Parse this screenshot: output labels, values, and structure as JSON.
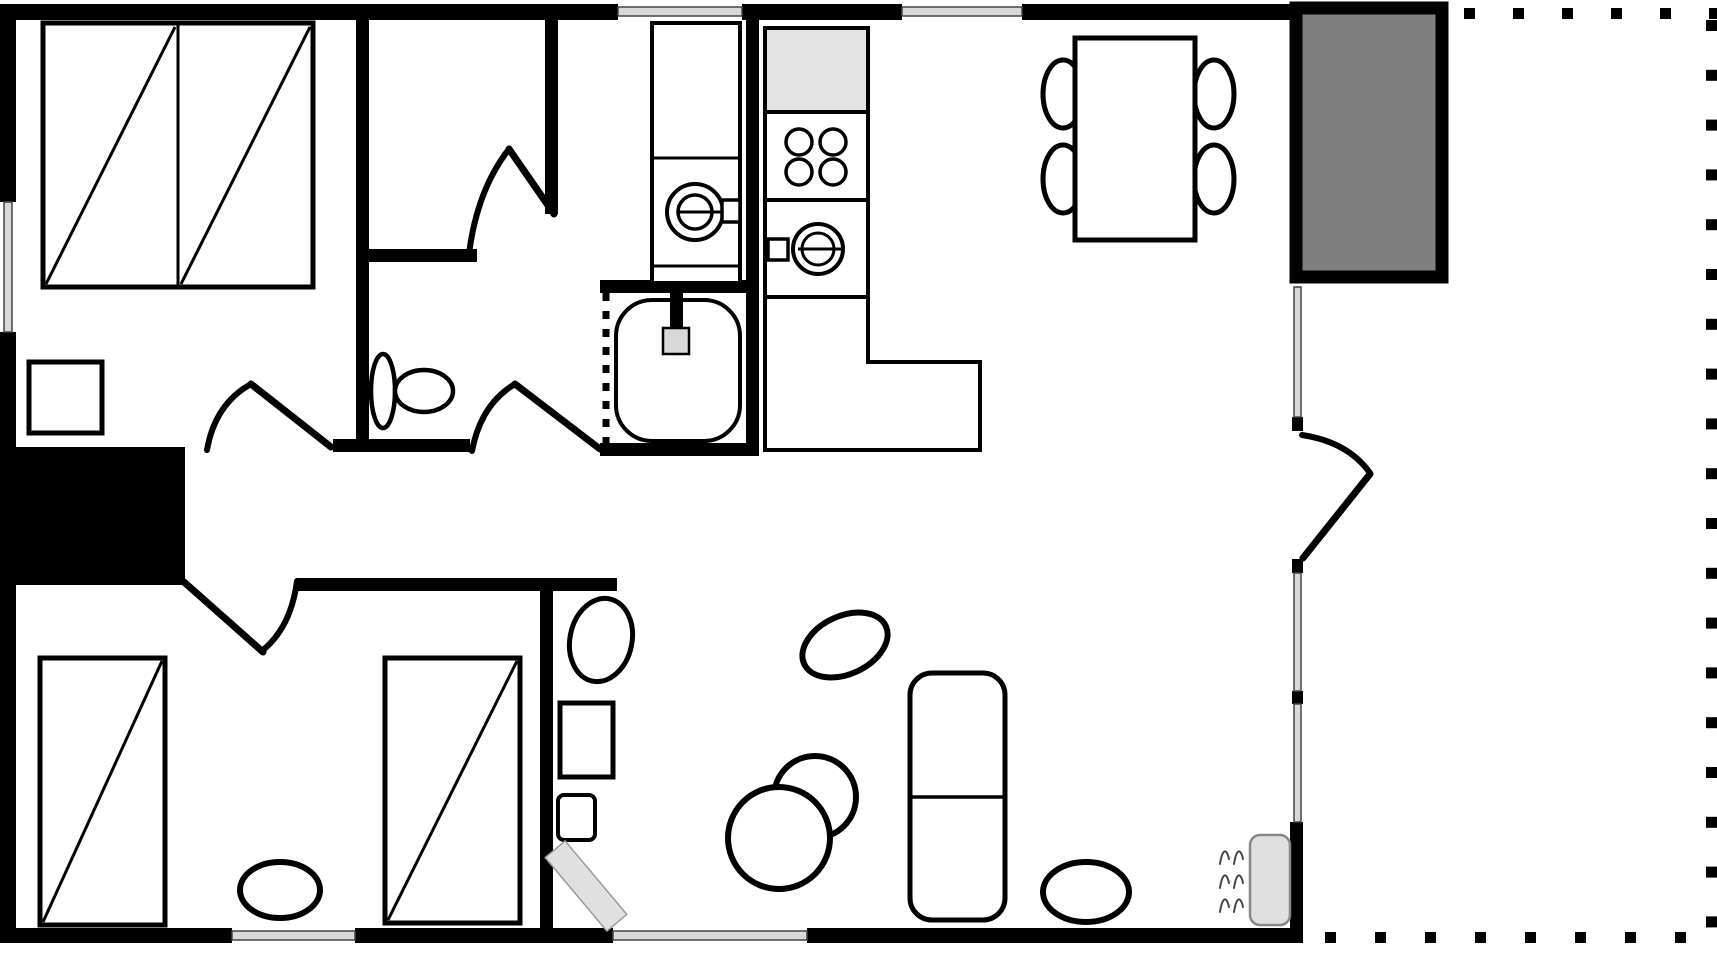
{
  "diagram": {
    "type": "floor-plan",
    "canvas": {
      "width": 1717,
      "height": 955,
      "background": "#ffffff"
    },
    "colors": {
      "wall": "#000000",
      "window_glass": "#d9d9d9",
      "porch_fill": "#7f7f7f",
      "appliance_fill": "#e3e3e3",
      "slab_fill": "#e0e0e0",
      "line": "#000000"
    },
    "elements": [
      {
        "name": "wall-top-left",
        "type": "rect",
        "x": 0,
        "y": 4,
        "w": 618,
        "h": 16,
        "fill": "#000000"
      },
      {
        "name": "wall-top-mid",
        "type": "rect",
        "x": 742,
        "y": 4,
        "w": 160,
        "h": 16,
        "fill": "#000000"
      },
      {
        "name": "wall-top-right",
        "type": "rect",
        "x": 1022,
        "y": 4,
        "w": 272,
        "h": 16,
        "fill": "#000000"
      },
      {
        "name": "wall-left-upper",
        "type": "rect",
        "x": 0,
        "y": 4,
        "w": 16,
        "h": 198,
        "fill": "#000000"
      },
      {
        "name": "wall-left-lower",
        "type": "rect",
        "x": 0,
        "y": 332,
        "w": 16,
        "h": 611,
        "fill": "#000000"
      },
      {
        "name": "wall-bottom-1",
        "type": "rect",
        "x": 0,
        "y": 928,
        "w": 232,
        "h": 15,
        "fill": "#000000"
      },
      {
        "name": "wall-bottom-2",
        "type": "rect",
        "x": 355,
        "y": 928,
        "w": 258,
        "h": 15,
        "fill": "#000000"
      },
      {
        "name": "wall-bottom-3",
        "type": "rect",
        "x": 807,
        "y": 928,
        "w": 496,
        "h": 15,
        "fill": "#000000"
      },
      {
        "name": "wall-right-lower",
        "type": "rect",
        "x": 1290,
        "y": 822,
        "w": 13,
        "h": 121,
        "fill": "#000000"
      },
      {
        "name": "entry-door-post-top",
        "type": "rect",
        "x": 1292,
        "y": 417,
        "w": 11,
        "h": 14,
        "fill": "#000000"
      },
      {
        "name": "entry-door-post-bottom",
        "type": "rect",
        "x": 1292,
        "y": 559,
        "w": 11,
        "h": 14,
        "fill": "#000000"
      },
      {
        "name": "right-window-post",
        "type": "rect",
        "x": 1292,
        "y": 691,
        "w": 11,
        "h": 13,
        "fill": "#000000"
      },
      {
        "name": "wall-bedroom1-right",
        "type": "rect",
        "x": 356,
        "y": 16,
        "w": 13,
        "h": 426,
        "fill": "#000000"
      },
      {
        "name": "wall-closet-right",
        "type": "rect",
        "x": 545,
        "y": 16,
        "w": 13,
        "h": 198,
        "fill": "#000000"
      },
      {
        "name": "wall-kitchen",
        "type": "rect",
        "x": 746,
        "y": 16,
        "w": 13,
        "h": 440,
        "fill": "#000000"
      },
      {
        "name": "wall-closet-bottom",
        "type": "rect",
        "x": 356,
        "y": 249,
        "w": 121,
        "h": 13,
        "fill": "#000000"
      },
      {
        "name": "wall-laundry-divider",
        "type": "rect",
        "x": 600,
        "y": 280,
        "w": 159,
        "h": 13,
        "fill": "#000000"
      },
      {
        "name": "wall-toilet-bottom",
        "type": "rect",
        "x": 333,
        "y": 439,
        "w": 137,
        "h": 13,
        "fill": "#000000"
      },
      {
        "name": "wall-bathroom-bottom",
        "type": "rect",
        "x": 600,
        "y": 443,
        "w": 159,
        "h": 13,
        "fill": "#000000"
      },
      {
        "name": "wall-hall-bottom",
        "type": "rect",
        "x": 297,
        "y": 578,
        "w": 320,
        "h": 13,
        "fill": "#000000"
      },
      {
        "name": "wall-living-left",
        "type": "rect",
        "x": 540,
        "y": 578,
        "w": 13,
        "h": 350,
        "fill": "#000000"
      },
      {
        "name": "chimney-block",
        "type": "rect",
        "x": 6,
        "y": 447,
        "w": 179,
        "h": 138,
        "fill": "#000000"
      },
      {
        "name": "porch",
        "type": "rect",
        "x": 1296,
        "y": 8,
        "w": 146,
        "h": 269,
        "fill": "#7f7f7f",
        "stroke": "#000000",
        "sw": 13
      },
      {
        "name": "window-top-laundry",
        "type": "rect",
        "x": 618,
        "y": 7,
        "w": 124,
        "h": 9,
        "fill": "#d9d9d9",
        "stroke": "#444444",
        "sw": 1.5
      },
      {
        "name": "window-top-kitchen",
        "type": "rect",
        "x": 902,
        "y": 7,
        "w": 120,
        "h": 9,
        "fill": "#d9d9d9",
        "stroke": "#444444",
        "sw": 1.5
      },
      {
        "name": "window-left-bedroom1",
        "type": "rect",
        "x": 4,
        "y": 202,
        "w": 8,
        "h": 130,
        "fill": "#d9d9d9",
        "stroke": "#444444",
        "sw": 1.5
      },
      {
        "name": "window-bottom-bedroom2",
        "type": "rect",
        "x": 232,
        "y": 931,
        "w": 123,
        "h": 9,
        "fill": "#d9d9d9",
        "stroke": "#444444",
        "sw": 1.5
      },
      {
        "name": "window-bottom-living",
        "type": "rect",
        "x": 613,
        "y": 931,
        "w": 194,
        "h": 9,
        "fill": "#d9d9d9",
        "stroke": "#444444",
        "sw": 1.5
      },
      {
        "name": "window-right-upper",
        "type": "rect",
        "x": 1294,
        "y": 287,
        "w": 7,
        "h": 130,
        "fill": "#d9d9d9",
        "stroke": "#444444",
        "sw": 1.5
      },
      {
        "name": "window-right-middle",
        "type": "rect",
        "x": 1294,
        "y": 573,
        "w": 7,
        "h": 118,
        "fill": "#d9d9d9",
        "stroke": "#444444",
        "sw": 1.5
      },
      {
        "name": "window-right-lower",
        "type": "rect",
        "x": 1294,
        "y": 704,
        "w": 7,
        "h": 118,
        "fill": "#d9d9d9",
        "stroke": "#444444",
        "sw": 1.5
      },
      {
        "name": "double-bed-frame",
        "type": "rect",
        "x": 43,
        "y": 23,
        "w": 270,
        "h": 264,
        "fill": "#ffffff",
        "stroke": "#000000",
        "sw": 5
      },
      {
        "name": "double-bed-divider",
        "type": "line",
        "x1": 178,
        "y1": 25,
        "x2": 178,
        "y2": 285,
        "sw": 3
      },
      {
        "name": "double-bed-diagonal-left",
        "type": "line",
        "x1": 46,
        "y1": 284,
        "x2": 175,
        "y2": 27,
        "sw": 3
      },
      {
        "name": "double-bed-diagonal-right",
        "type": "line",
        "x1": 181,
        "y1": 284,
        "x2": 310,
        "y2": 27,
        "sw": 3
      },
      {
        "name": "nightstand",
        "type": "rect",
        "x": 29,
        "y": 362,
        "w": 73,
        "h": 71,
        "fill": "#ffffff",
        "stroke": "#000000",
        "sw": 5
      },
      {
        "name": "toilet-tank",
        "type": "ellipse",
        "cx": 383,
        "cy": 391,
        "rx": 12,
        "ry": 37,
        "fill": "#ffffff",
        "stroke": "#000000",
        "sw": 4.5
      },
      {
        "name": "toilet-bowl",
        "type": "ellipse",
        "cx": 424,
        "cy": 391,
        "rx": 29,
        "ry": 21,
        "fill": "#ffffff",
        "stroke": "#000000",
        "sw": 4.5
      },
      {
        "name": "washer-body",
        "type": "rect",
        "x": 652,
        "y": 23,
        "w": 88,
        "h": 260,
        "fill": "#ffffff",
        "stroke": "#000000",
        "sw": 4
      },
      {
        "name": "washer-panel-line",
        "type": "line",
        "x1": 652,
        "y1": 158,
        "x2": 740,
        "y2": 158,
        "sw": 3
      },
      {
        "name": "washer-base-line",
        "type": "line",
        "x1": 652,
        "y1": 266,
        "x2": 740,
        "y2": 266,
        "sw": 3
      },
      {
        "name": "washer-drum-outer",
        "type": "circle",
        "cx": 695,
        "cy": 212,
        "r": 28,
        "fill": "none",
        "stroke": "#000000",
        "sw": 4
      },
      {
        "name": "washer-drum-inner",
        "type": "circle",
        "cx": 695,
        "cy": 212,
        "r": 17,
        "fill": "none",
        "stroke": "#000000",
        "sw": 3.5
      },
      {
        "name": "washer-needle",
        "type": "line",
        "x1": 677,
        "y1": 212,
        "x2": 722,
        "y2": 212,
        "sw": 3
      },
      {
        "name": "washer-handle",
        "type": "rect",
        "x": 722,
        "y": 200,
        "w": 18,
        "h": 22,
        "fill": "#ffffff",
        "stroke": "#000000",
        "sw": 3.5
      },
      {
        "name": "shower-tray",
        "type": "rect",
        "x": 616,
        "y": 300,
        "w": 124,
        "h": 141,
        "rx": 36,
        "fill": "#ffffff",
        "stroke": "#000000",
        "sw": 4
      },
      {
        "name": "shower-curtain-line",
        "type": "line",
        "x1": 606,
        "y1": 293,
        "x2": 606,
        "y2": 446,
        "sw": 7,
        "dash": "8 10"
      },
      {
        "name": "shower-pipe",
        "type": "rect",
        "x": 670,
        "y": 284,
        "w": 13,
        "h": 46,
        "fill": "#000000"
      },
      {
        "name": "shower-head",
        "type": "rect",
        "x": 663,
        "y": 328,
        "w": 26,
        "h": 26,
        "fill": "#d9d9d9",
        "stroke": "#000000",
        "sw": 2.5
      },
      {
        "name": "fridge",
        "type": "rect",
        "x": 765,
        "y": 28,
        "w": 103,
        "h": 84,
        "fill": "#e3e3e3",
        "stroke": "#000000",
        "sw": 4
      },
      {
        "name": "stove",
        "type": "rect",
        "x": 765,
        "y": 112,
        "w": 103,
        "h": 88,
        "fill": "#ffffff",
        "stroke": "#000000",
        "sw": 4
      },
      {
        "name": "burner-1",
        "type": "circle",
        "cx": 799,
        "cy": 142,
        "r": 13,
        "fill": "none",
        "stroke": "#000000",
        "sw": 3.5
      },
      {
        "name": "burner-2",
        "type": "circle",
        "cx": 833,
        "cy": 142,
        "r": 13,
        "fill": "none",
        "stroke": "#000000",
        "sw": 3.5
      },
      {
        "name": "burner-3",
        "type": "circle",
        "cx": 799,
        "cy": 172,
        "r": 13,
        "fill": "none",
        "stroke": "#000000",
        "sw": 3.5
      },
      {
        "name": "burner-4",
        "type": "circle",
        "cx": 833,
        "cy": 172,
        "r": 13,
        "fill": "none",
        "stroke": "#000000",
        "sw": 3.5
      },
      {
        "name": "oven",
        "type": "rect",
        "x": 765,
        "y": 200,
        "w": 103,
        "h": 97,
        "fill": "#ffffff",
        "stroke": "#000000",
        "sw": 4
      },
      {
        "name": "oven-door-outer",
        "type": "circle",
        "cx": 818,
        "cy": 249,
        "r": 25,
        "fill": "none",
        "stroke": "#000000",
        "sw": 4
      },
      {
        "name": "oven-door-inner",
        "type": "circle",
        "cx": 818,
        "cy": 249,
        "r": 16,
        "fill": "none",
        "stroke": "#000000",
        "sw": 3
      },
      {
        "name": "oven-needle",
        "type": "line",
        "x1": 798,
        "y1": 249,
        "x2": 843,
        "y2": 249,
        "sw": 3
      },
      {
        "name": "oven-handle",
        "type": "rect",
        "x": 768,
        "y": 239,
        "w": 20,
        "h": 21,
        "fill": "#ffffff",
        "stroke": "#000000",
        "sw": 3.5
      },
      {
        "name": "kitchen-counter",
        "type": "path",
        "d": "M765,297 L765,450 L980,450 L980,362 L868,362 L868,297 Z",
        "fill": "#ffffff",
        "stroke": "#000000",
        "sw": 4
      },
      {
        "name": "dining-chair-1",
        "type": "ellipse",
        "cx": 1063,
        "cy": 94,
        "rx": 20,
        "ry": 34,
        "fill": "#ffffff",
        "stroke": "#000000",
        "sw": 5
      },
      {
        "name": "dining-chair-2",
        "type": "ellipse",
        "cx": 1063,
        "cy": 179,
        "rx": 20,
        "ry": 34,
        "fill": "#ffffff",
        "stroke": "#000000",
        "sw": 5
      },
      {
        "name": "dining-chair-3",
        "type": "ellipse",
        "cx": 1214,
        "cy": 94,
        "rx": 20,
        "ry": 34,
        "fill": "#ffffff",
        "stroke": "#000000",
        "sw": 5
      },
      {
        "name": "dining-chair-4",
        "type": "ellipse",
        "cx": 1214,
        "cy": 179,
        "rx": 20,
        "ry": 34,
        "fill": "#ffffff",
        "stroke": "#000000",
        "sw": 5
      },
      {
        "name": "dining-table",
        "type": "rect",
        "x": 1075,
        "y": 38,
        "w": 120,
        "h": 202,
        "fill": "#ffffff",
        "stroke": "#000000",
        "sw": 5
      },
      {
        "name": "living-chair-ellipse",
        "type": "ellipse",
        "cx": 601,
        "cy": 640,
        "rx": 31,
        "ry": 42,
        "rot": 12,
        "fill": "#ffffff",
        "stroke": "#000000",
        "sw": 5
      },
      {
        "name": "side-table",
        "type": "rect",
        "x": 560,
        "y": 703,
        "w": 53,
        "h": 74,
        "fill": "#ffffff",
        "stroke": "#000000",
        "sw": 5
      },
      {
        "name": "small-stool",
        "type": "rect",
        "x": 558,
        "y": 795,
        "w": 37,
        "h": 45,
        "rx": 6,
        "fill": "#ffffff",
        "stroke": "#000000",
        "sw": 4
      },
      {
        "name": "bench-slab",
        "type": "rect",
        "x": 573,
        "y": 838,
        "w": 26,
        "h": 96,
        "rot": -40,
        "fill": "#e0e0e0",
        "stroke": "#999999",
        "sw": 1.5
      },
      {
        "name": "armchair-small",
        "type": "circle",
        "cx": 815,
        "cy": 797,
        "r": 41,
        "fill": "#ffffff",
        "stroke": "#000000",
        "sw": 6
      },
      {
        "name": "armchair-big",
        "type": "circle",
        "cx": 779,
        "cy": 838,
        "r": 51,
        "fill": "#ffffff",
        "stroke": "#000000",
        "sw": 6
      },
      {
        "name": "lounge-ellipse",
        "type": "ellipse",
        "cx": 845,
        "cy": 645,
        "rx": 45,
        "ry": 29,
        "rot": -25,
        "fill": "#ffffff",
        "stroke": "#000000",
        "sw": 6
      },
      {
        "name": "sofa",
        "type": "rect",
        "x": 910,
        "y": 673,
        "w": 95,
        "h": 247,
        "rx": 22,
        "fill": "#ffffff",
        "stroke": "#000000",
        "sw": 5
      },
      {
        "name": "sofa-divider",
        "type": "line",
        "x1": 910,
        "y1": 797,
        "x2": 1005,
        "y2": 797,
        "sw": 3.5
      },
      {
        "name": "pouf",
        "type": "ellipse",
        "cx": 1086,
        "cy": 892,
        "rx": 43,
        "ry": 30,
        "fill": "#ffffff",
        "stroke": "#000000",
        "sw": 6
      },
      {
        "name": "radiator",
        "type": "rect",
        "x": 1250,
        "y": 835,
        "w": 40,
        "h": 90,
        "rx": 10,
        "fill": "#e0e0e0",
        "stroke": "#888888",
        "sw": 2.5
      },
      {
        "name": "heat-wave-1",
        "type": "path",
        "d": "M1220,864 C1222,851 1226,846 1229,859 M1234,864 C1236,851 1240,846 1243,859",
        "fill": "none",
        "stroke": "#444444",
        "sw": 2
      },
      {
        "name": "heat-wave-2",
        "type": "path",
        "d": "M1220,888 C1222,875 1226,870 1229,883 M1234,888 C1236,875 1240,870 1243,883",
        "fill": "none",
        "stroke": "#444444",
        "sw": 2
      },
      {
        "name": "heat-wave-3",
        "type": "path",
        "d": "M1220,912 C1222,899 1226,894 1229,907 M1234,912 C1236,899 1240,894 1243,907",
        "fill": "none",
        "stroke": "#444444",
        "sw": 2
      },
      {
        "name": "single-bed-left",
        "type": "rect",
        "x": 40,
        "y": 658,
        "w": 125,
        "h": 267,
        "fill": "#ffffff",
        "stroke": "#000000",
        "sw": 5
      },
      {
        "name": "single-bed-left-diagonal",
        "type": "line",
        "x1": 43,
        "y1": 922,
        "x2": 162,
        "y2": 661,
        "sw": 3
      },
      {
        "name": "single-bed-right",
        "type": "rect",
        "x": 385,
        "y": 658,
        "w": 135,
        "h": 265,
        "fill": "#ffffff",
        "stroke": "#000000",
        "sw": 5
      },
      {
        "name": "single-bed-right-diagonal",
        "type": "line",
        "x1": 388,
        "y1": 920,
        "x2": 517,
        "y2": 661,
        "sw": 3
      },
      {
        "name": "bedroom2-rug",
        "type": "ellipse",
        "cx": 280,
        "cy": 890,
        "rx": 40,
        "ry": 28,
        "fill": "#ffffff",
        "stroke": "#000000",
        "sw": 6
      },
      {
        "name": "bedroom1-door-leaf",
        "type": "line",
        "x1": 251,
        "y1": 384,
        "x2": 331,
        "y2": 447,
        "sw": 7,
        "cap": "round"
      },
      {
        "name": "bedroom1-door-arc",
        "type": "path",
        "d": "M207,450 Q215,404 251,384",
        "fill": "none",
        "stroke": "#000000",
        "sw": 6
      },
      {
        "name": "closet-door-leaf",
        "type": "line",
        "x1": 509,
        "y1": 149,
        "x2": 554,
        "y2": 214,
        "sw": 7,
        "cap": "round"
      },
      {
        "name": "closet-door-arc",
        "type": "path",
        "d": "M469,254 Q477,190 509,149",
        "fill": "none",
        "stroke": "#000000",
        "sw": 6
      },
      {
        "name": "bathroom-door-leaf",
        "type": "line",
        "x1": 515,
        "y1": 384,
        "x2": 600,
        "y2": 449,
        "sw": 7,
        "cap": "round"
      },
      {
        "name": "bathroom-door-arc",
        "type": "path",
        "d": "M472,451 Q481,404 515,384",
        "fill": "none",
        "stroke": "#000000",
        "sw": 6
      },
      {
        "name": "bedroom2-door-leaf",
        "type": "line",
        "x1": 184,
        "y1": 582,
        "x2": 263,
        "y2": 652,
        "sw": 7,
        "cap": "round"
      },
      {
        "name": "bedroom2-door-arc",
        "type": "path",
        "d": "M297,581 Q291,627 263,650",
        "fill": "none",
        "stroke": "#000000",
        "sw": 6
      },
      {
        "name": "entry-door-leaf",
        "type": "line",
        "x1": 1370,
        "y1": 474,
        "x2": 1303,
        "y2": 558,
        "sw": 7,
        "cap": "round"
      },
      {
        "name": "entry-door-arc",
        "type": "path",
        "d": "M1302,435 Q1348,442 1370,473",
        "fill": "none",
        "stroke": "#000000",
        "sw": 6
      },
      {
        "name": "terrace-dots-top",
        "type": "dots",
        "x": 1464,
        "y": 8,
        "dx": 49,
        "dy": 0,
        "count": 6,
        "size": 11
      },
      {
        "name": "terrace-dots-right",
        "type": "dots",
        "x": 1706,
        "y": 20,
        "dx": 0,
        "dy": 49.8,
        "count": 19,
        "size": 11
      },
      {
        "name": "terrace-dots-bottom",
        "type": "dots",
        "x": 1325,
        "y": 932,
        "dx": 50,
        "dy": 0,
        "count": 8,
        "size": 11
      }
    ]
  }
}
